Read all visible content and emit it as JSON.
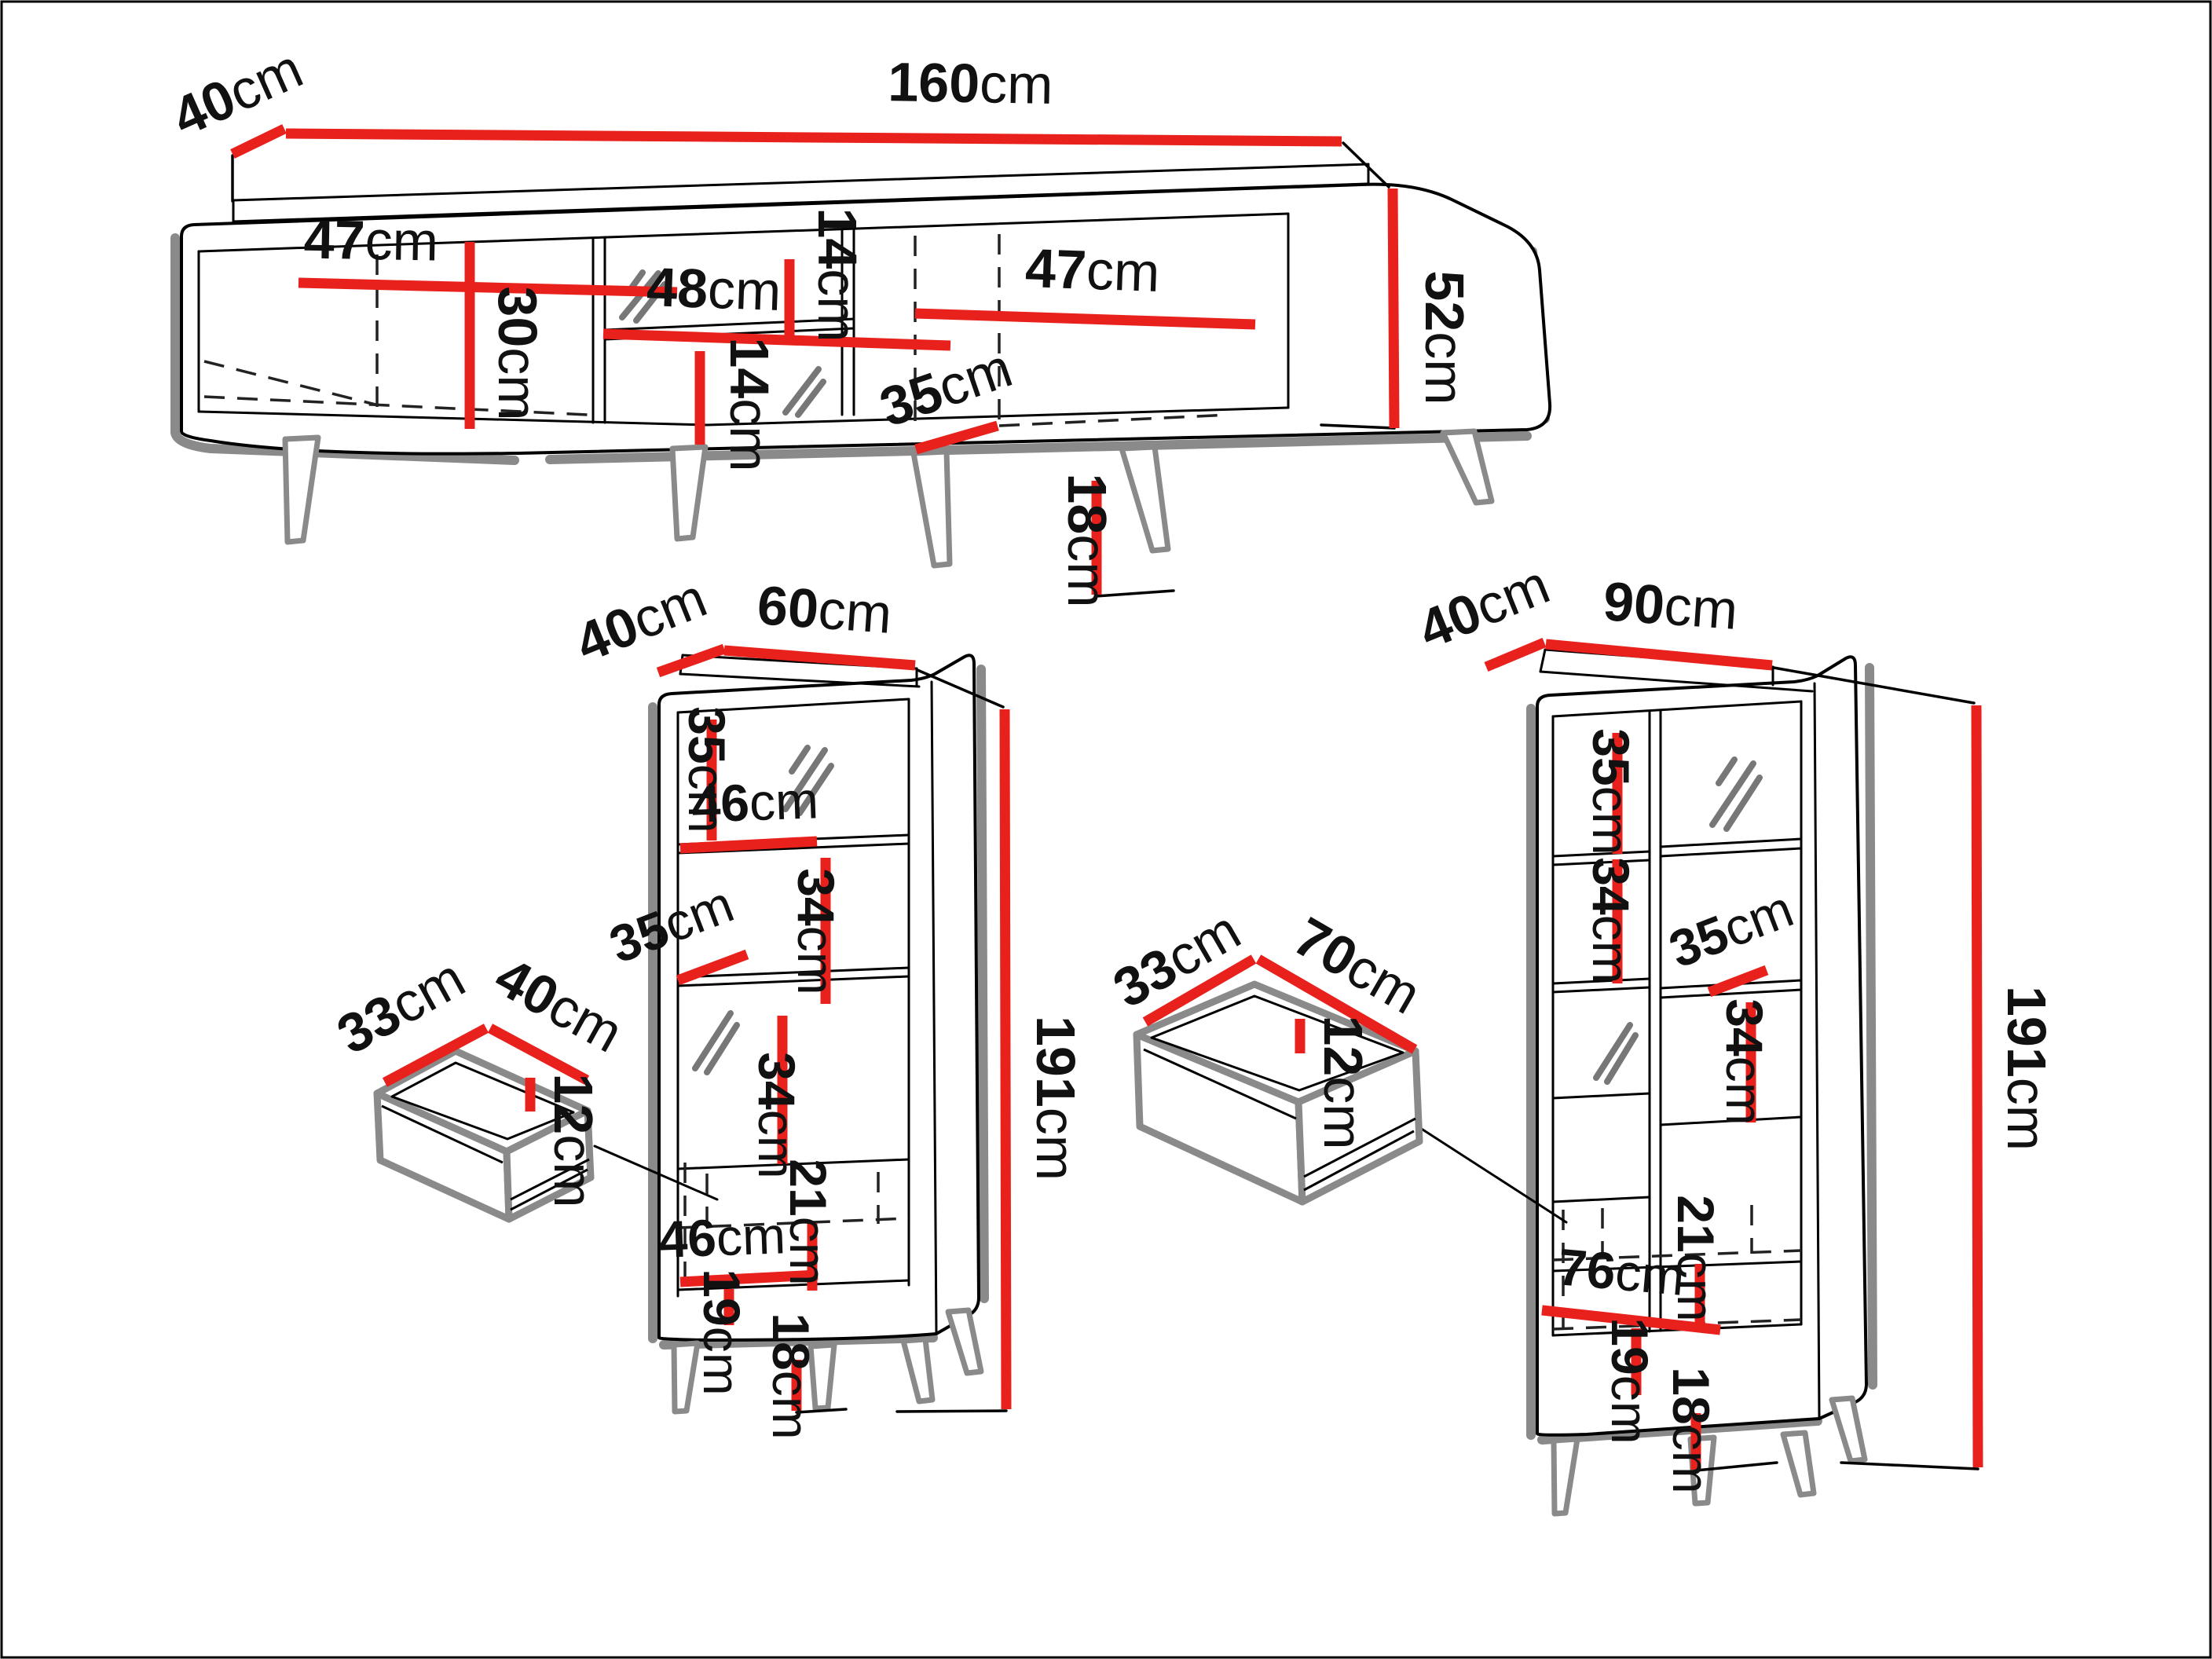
{
  "page": {
    "background": "#ffffff",
    "border_color": "#000000"
  },
  "colors": {
    "dimension_red": "#e8211c",
    "outline_black": "#000000",
    "shadow_gray": "#8a8a8a"
  },
  "tv_stand": {
    "depth": {
      "v": "40",
      "u": "cm"
    },
    "width": {
      "v": "160",
      "u": "cm"
    },
    "left_door_width": {
      "v": "47",
      "u": "cm"
    },
    "left_door_height": {
      "v": "30",
      "u": "cm"
    },
    "niche_width": {
      "v": "48",
      "u": "cm"
    },
    "niche_top_height": {
      "v": "14",
      "u": "cm"
    },
    "niche_bottom_height": {
      "v": "14",
      "u": "cm"
    },
    "right_door_width": {
      "v": "47",
      "u": "cm"
    },
    "inner_depth": {
      "v": "35",
      "u": "cm"
    },
    "body_height": {
      "v": "52",
      "u": "cm"
    },
    "leg_height": {
      "v": "18",
      "u": "cm"
    }
  },
  "tall_cabinet": {
    "depth": {
      "v": "40",
      "u": "cm"
    },
    "width": {
      "v": "60",
      "u": "cm"
    },
    "top_section_height": {
      "v": "35",
      "u": "cm"
    },
    "shelf_width": {
      "v": "46",
      "u": "cm"
    },
    "second_section_height": {
      "v": "34",
      "u": "cm"
    },
    "shelf_depth": {
      "v": "35",
      "u": "cm"
    },
    "third_section_height": {
      "v": "34",
      "u": "cm"
    },
    "drawer_section_height": {
      "v": "21",
      "u": "cm"
    },
    "bottom_door_width": {
      "v": "46",
      "u": "cm"
    },
    "bottom_section_height": {
      "v": "19",
      "u": "cm"
    },
    "leg_height": {
      "v": "18",
      "u": "cm"
    },
    "total_height": {
      "v": "191",
      "u": "cm"
    }
  },
  "small_drawer": {
    "depth": {
      "v": "33",
      "u": "cm"
    },
    "width": {
      "v": "40",
      "u": "cm"
    },
    "height": {
      "v": "12",
      "u": "cm"
    }
  },
  "wide_cabinet": {
    "depth": {
      "v": "40",
      "u": "cm"
    },
    "width": {
      "v": "90",
      "u": "cm"
    },
    "top_section_height": {
      "v": "35",
      "u": "cm"
    },
    "second_section_height": {
      "v": "34",
      "u": "cm"
    },
    "shelf_depth": {
      "v": "35",
      "u": "cm"
    },
    "door_section_height": {
      "v": "34",
      "u": "cm"
    },
    "drawer_section_height": {
      "v": "21",
      "u": "cm"
    },
    "bottom_door_width": {
      "v": "76",
      "u": "cm"
    },
    "bottom_section_height": {
      "v": "19",
      "u": "cm"
    },
    "leg_height": {
      "v": "18",
      "u": "cm"
    },
    "total_height": {
      "v": "191",
      "u": "cm"
    }
  },
  "large_drawer": {
    "depth": {
      "v": "33",
      "u": "cm"
    },
    "width": {
      "v": "70",
      "u": "cm"
    },
    "height": {
      "v": "12",
      "u": "cm"
    }
  }
}
